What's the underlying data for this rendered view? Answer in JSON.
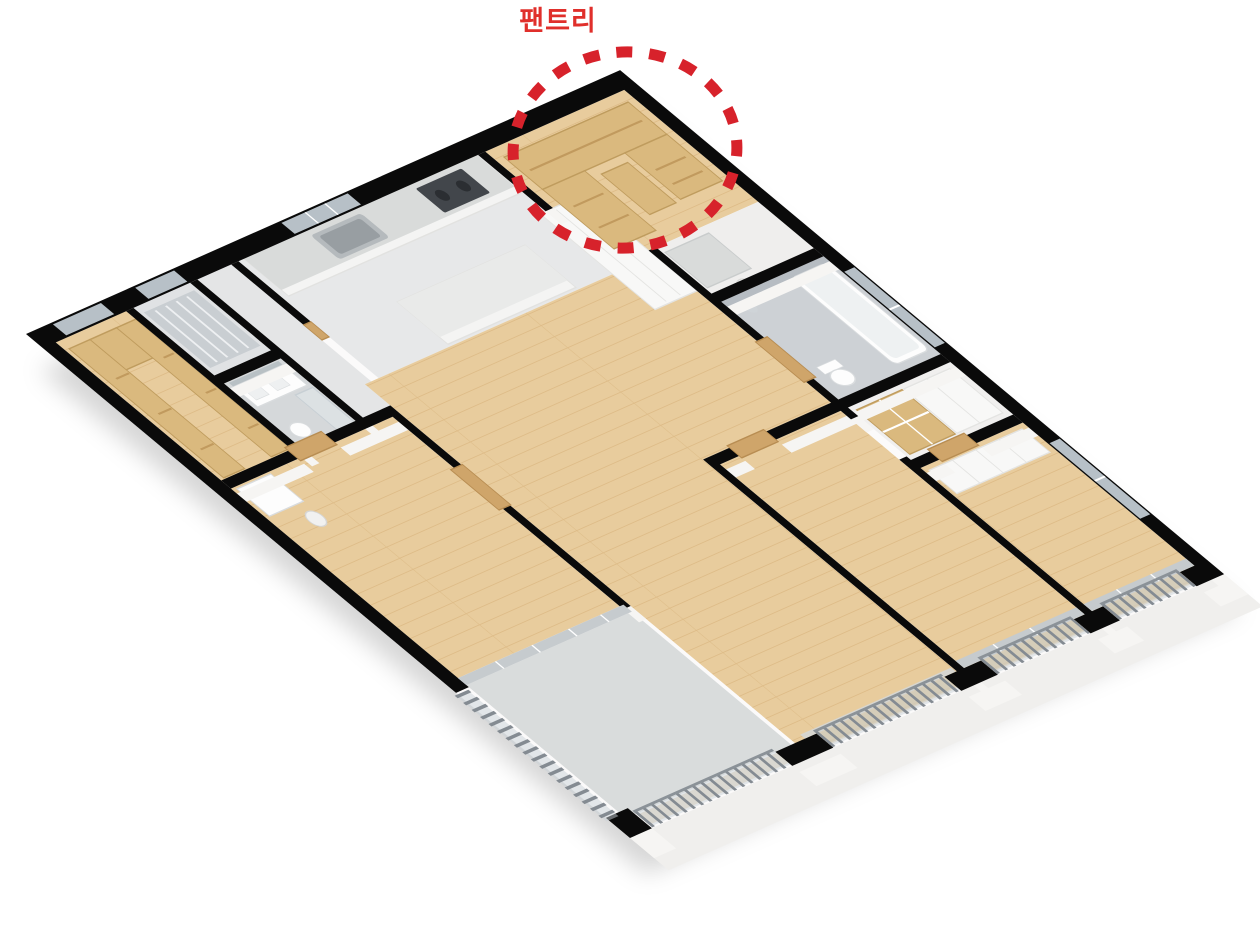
{
  "annotation": {
    "label": "팬트리",
    "label_color": "#e02f2b",
    "circle_color": "#d7222b"
  },
  "palette": {
    "background": "#ffffff",
    "wall": "#0a0a0a",
    "wall_face": "#f6f5f3",
    "slab": "#f0efed",
    "base": "#fbfafa",
    "wood_floor": "#e8cc9d",
    "plank_line": "#d4ae77",
    "shelf_wood": "#dab97e",
    "shelf_wood_edge": "#bf9c5e",
    "shelf_line": "#c19a5e",
    "door_wood": "#cfa56a",
    "door_wood_edge": "#b88d52",
    "tile_bath": "#cdd1d5",
    "tile_bath2": "#d5d8da",
    "tile_kitchen": "#e7e8e9",
    "tile_utility": "#e0e2e4",
    "tile_foyer": "#e4e5e6",
    "tile_balcony": "#d9dcdc",
    "floor_entry": "#efeeed",
    "floor_closet": "#f0efee",
    "counter_white": "#f4f4f3",
    "counter_edge": "#e2e2e0",
    "counter_top": "#d9dbda",
    "cooktop": "#42464b",
    "burner": "#2b2e32",
    "sink_steel": "#b5babd",
    "sink_inner": "#989ea2",
    "cabinet_white": "#f8f8f7",
    "cabinet_edge": "#e4e4e2",
    "mirror": "#b8c0c4",
    "window_glass": "#b7c0c7",
    "window_frame_grey": "#c6cbce",
    "glass_panel": "#c9d2d8",
    "railing_bar": "#848b92",
    "railing_rail": "#8b9298",
    "railing_slat": "#d9c49a",
    "fixture_white": "#fdfdfd",
    "fixture_edge": "#d9dcde",
    "shadow": "rgba(0,0,0,0.16)"
  }
}
